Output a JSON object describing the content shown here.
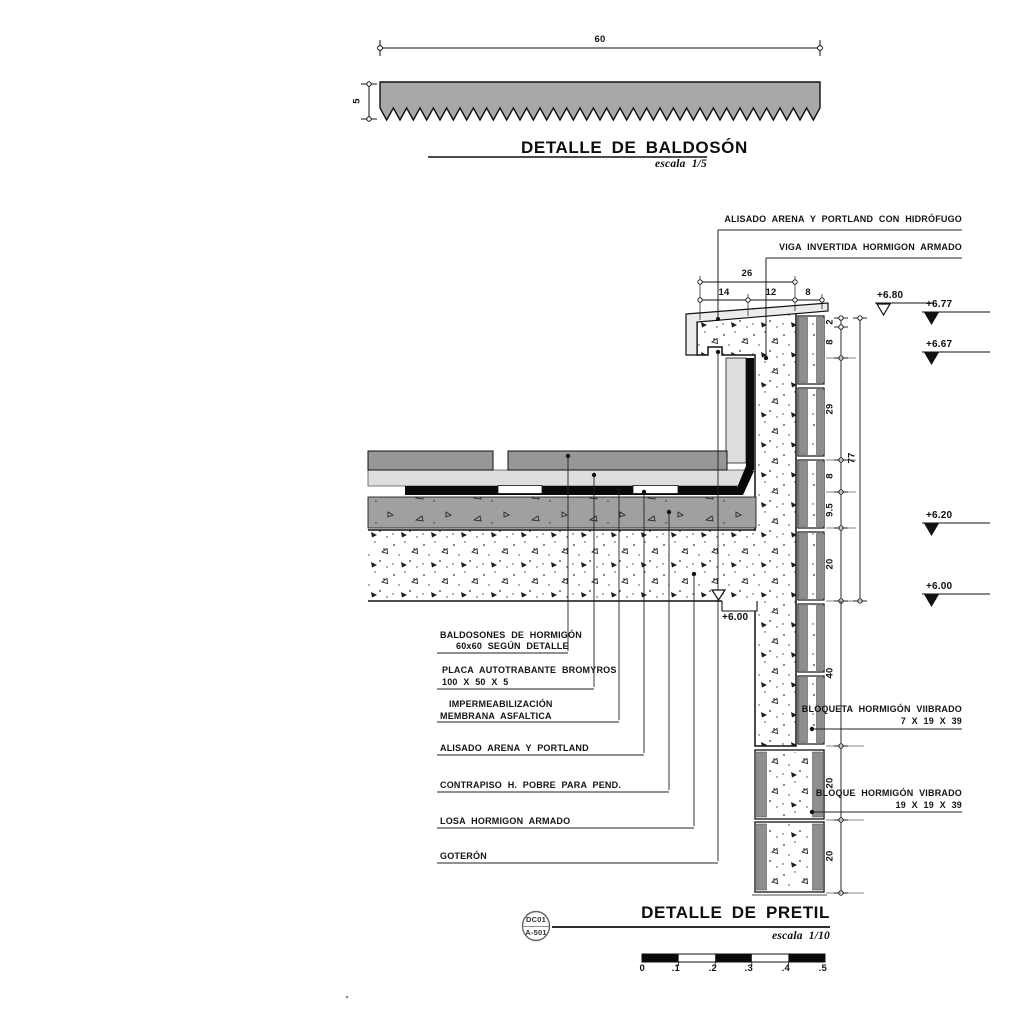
{
  "colors": {
    "tile_gray": "#979797",
    "screed_light": "#dedede",
    "contrapiso_gray": "#a0a0a0",
    "membrane_black": "#0a0a0a",
    "block_shell_gray": "#8e8e8e",
    "coating_light": "#ececec",
    "bar_gray": "#a8a8a8",
    "line_dark": "#141414"
  },
  "baldoson": {
    "title": "DETALLE DE BALDOSÓN",
    "scale": "escala 1/5",
    "dim_width": "60",
    "dim_thickness": "5"
  },
  "pretil": {
    "title": "DETALLE DE PRETIL",
    "scale": "escala 1/10",
    "labels_top": [
      "ALISADO ARENA Y PORTLAND CON HIDRÓFUGO",
      "VIGA INVERTIDA HORMIGON ARMADO"
    ],
    "labels_left": [
      {
        "l1": "BALDOSONES DE HORMIGÓN",
        "l2": "60x60 SEGÚN DETALLE"
      },
      {
        "l1": "PLACA AUTOTRABANTE BROMYROS",
        "l2": "100 X 50 X 5"
      },
      {
        "l1": "IMPERMEABILIZACIÓN",
        "l2": "MEMBRANA ASFALTICA"
      },
      {
        "l1": "ALISADO ARENA Y PORTLAND",
        "l2": ""
      },
      {
        "l1": "CONTRAPISO H. POBRE PARA PEND.",
        "l2": ""
      },
      {
        "l1": "LOSA HORMIGON ARMADO",
        "l2": ""
      },
      {
        "l1": "GOTERÓN",
        "l2": ""
      }
    ],
    "labels_right": [
      {
        "l1": "BLOQUETA HORMIGÓN VIIBRADO",
        "l2": "7 X 19 X 39"
      },
      {
        "l1": "BLOQUE HORMIGÓN VIBRADO",
        "l2": "19 X 19 X 39"
      }
    ],
    "dim_total_top": "26",
    "dims_top": [
      "14",
      "12",
      "8"
    ],
    "dims_right_upper": [
      "2",
      "8",
      "29",
      "8",
      "9.5",
      "20"
    ],
    "dim_right_total": "77",
    "dims_right_lower": [
      "40",
      "20",
      "20"
    ],
    "elevations": [
      "+6.80",
      "+6.77",
      "+6.67",
      "+6.20",
      "+6.00"
    ],
    "elevation_soffit": "+6.00"
  },
  "title_block": {
    "sheet_code": "DC01",
    "sheet_ref": "A-501"
  },
  "scale_bar": {
    "ticks": [
      "0",
      ".1",
      ".2",
      ".3",
      ".4",
      ".5"
    ]
  }
}
